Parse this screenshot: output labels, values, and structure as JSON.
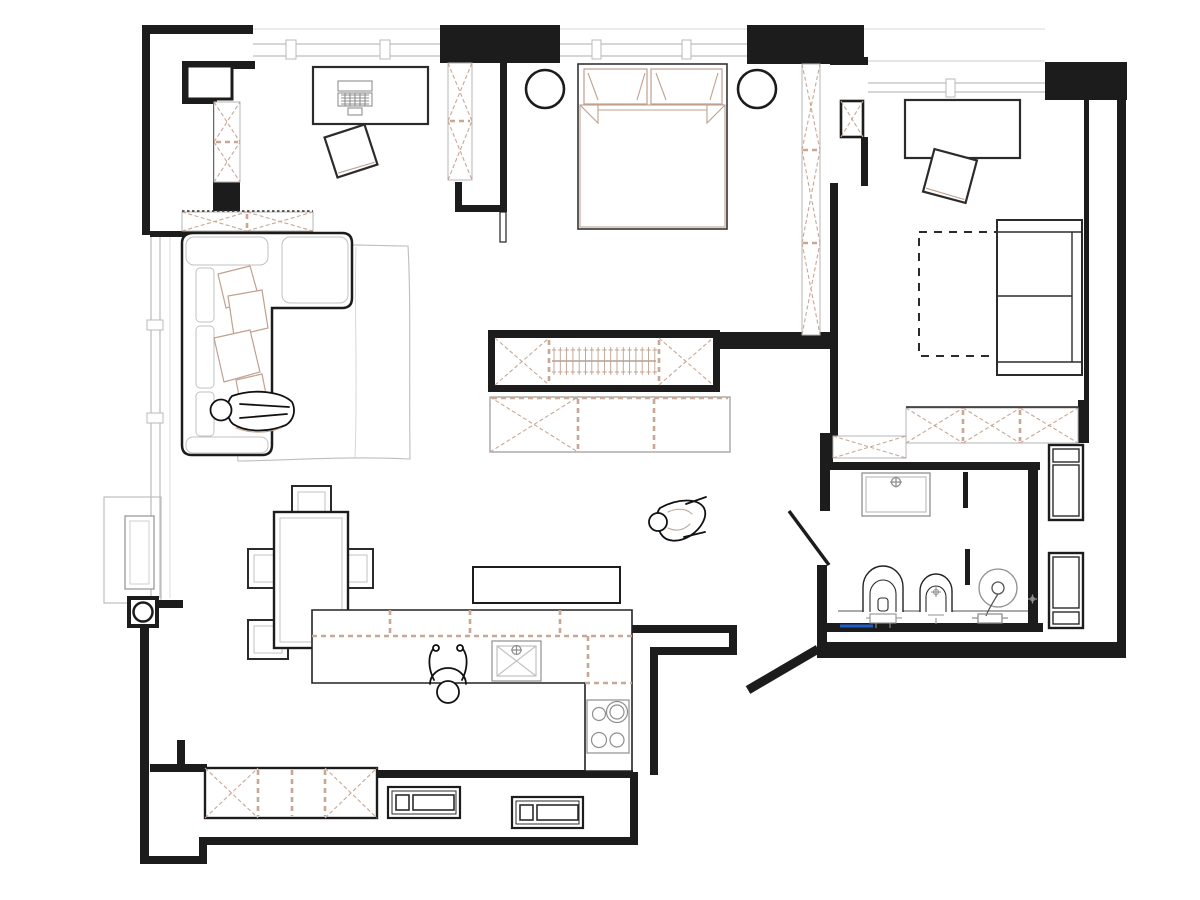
{
  "title": "apartment-floor-plan",
  "colors": {
    "paper": "#ffffff",
    "wall": "#1c1c1c",
    "hatch": "#c8a795",
    "sketch": "#bfa18f",
    "window": "#c9c9c9",
    "furniture_gray": "#8f8f8f",
    "accent_blue": "#1e5ec8"
  },
  "rooms": {
    "office": {
      "label": "office",
      "furniture": [
        "desk",
        "laptop",
        "chair",
        "corner-wardrobe",
        "ventilation-shaft"
      ]
    },
    "bedroom": {
      "label": "bedroom",
      "furniture": [
        "double-bed",
        "pillow-left",
        "pillow-right",
        "round-nightstand-left",
        "round-nightstand-right",
        "wall-wardrobe",
        "walk-in-closet"
      ],
      "closet": {
        "hanger_count": 17,
        "sections": [
          "x-shelf",
          "hanging-rod",
          "x-shelf"
        ]
      }
    },
    "study": {
      "label": "study",
      "furniture": [
        "desk",
        "chair",
        "sofa-bed",
        "pull-out-bed-dashed",
        "hatched-column"
      ]
    },
    "living_room": {
      "label": "living room",
      "furniture": [
        "corner-sofa",
        "cushions",
        "rug",
        "tv-console",
        "person-lying"
      ]
    },
    "dining": {
      "label": "dining area",
      "table_seats": 4,
      "furniture": [
        "dining-table",
        "chair-top",
        "chair-left-1",
        "chair-left-2",
        "chair-right"
      ]
    },
    "kitchen": {
      "label": "kitchen",
      "burner_count": 4,
      "furniture": [
        "l-shaped-counter",
        "upper-cabinets-dashed",
        "sink",
        "cooktop",
        "wall-shelf",
        "niche-wardrobe",
        "radiator-1",
        "radiator-2",
        "person-at-counter"
      ]
    },
    "bathroom": {
      "label": "bathroom",
      "furniture": [
        "washbasin",
        "toilet",
        "bidet",
        "shower",
        "glass-partition",
        "towel-rail-blue",
        "floor-drain"
      ]
    },
    "hallway": {
      "label": "hallway",
      "furniture": [
        "corridor-wardrobe",
        "tall-cabinet-1",
        "tall-cabinet-2",
        "person-walking",
        "entry-diagonal-wall"
      ]
    },
    "balcony": {
      "label": "balcony",
      "furniture": [
        "planter"
      ]
    }
  }
}
